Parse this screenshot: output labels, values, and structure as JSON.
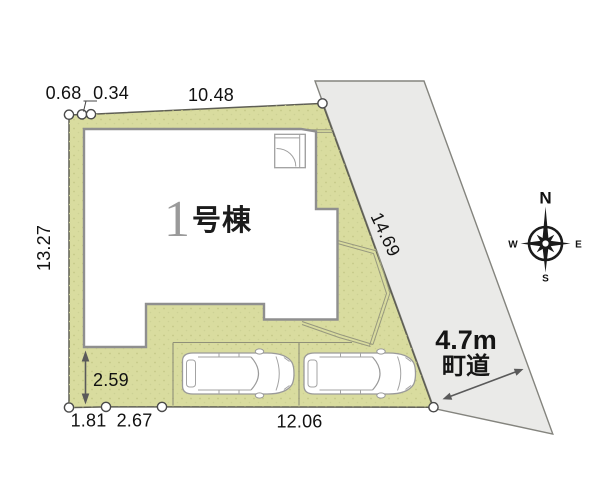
{
  "site_plan": {
    "building": {
      "number": "1",
      "name_suffix": "号棟"
    },
    "road": {
      "width": "4.7m",
      "type": "町道"
    },
    "dimensions": {
      "top_offset_a": "0.68",
      "top_offset_b": "0.34",
      "top_edge": "10.48",
      "west_edge": "13.27",
      "road_edge": "14.69",
      "south_gap": "2.59",
      "south_a": "1.81",
      "south_b": "2.67",
      "south_c": "12.06"
    },
    "compass": {
      "north": "N",
      "east": "E",
      "south": "S",
      "west": "W"
    },
    "colors": {
      "land": "#d9dc9f",
      "land_speckle": "#c4c888",
      "road": "#eaeae8",
      "building_outline": "#8f8f8f"
    }
  }
}
